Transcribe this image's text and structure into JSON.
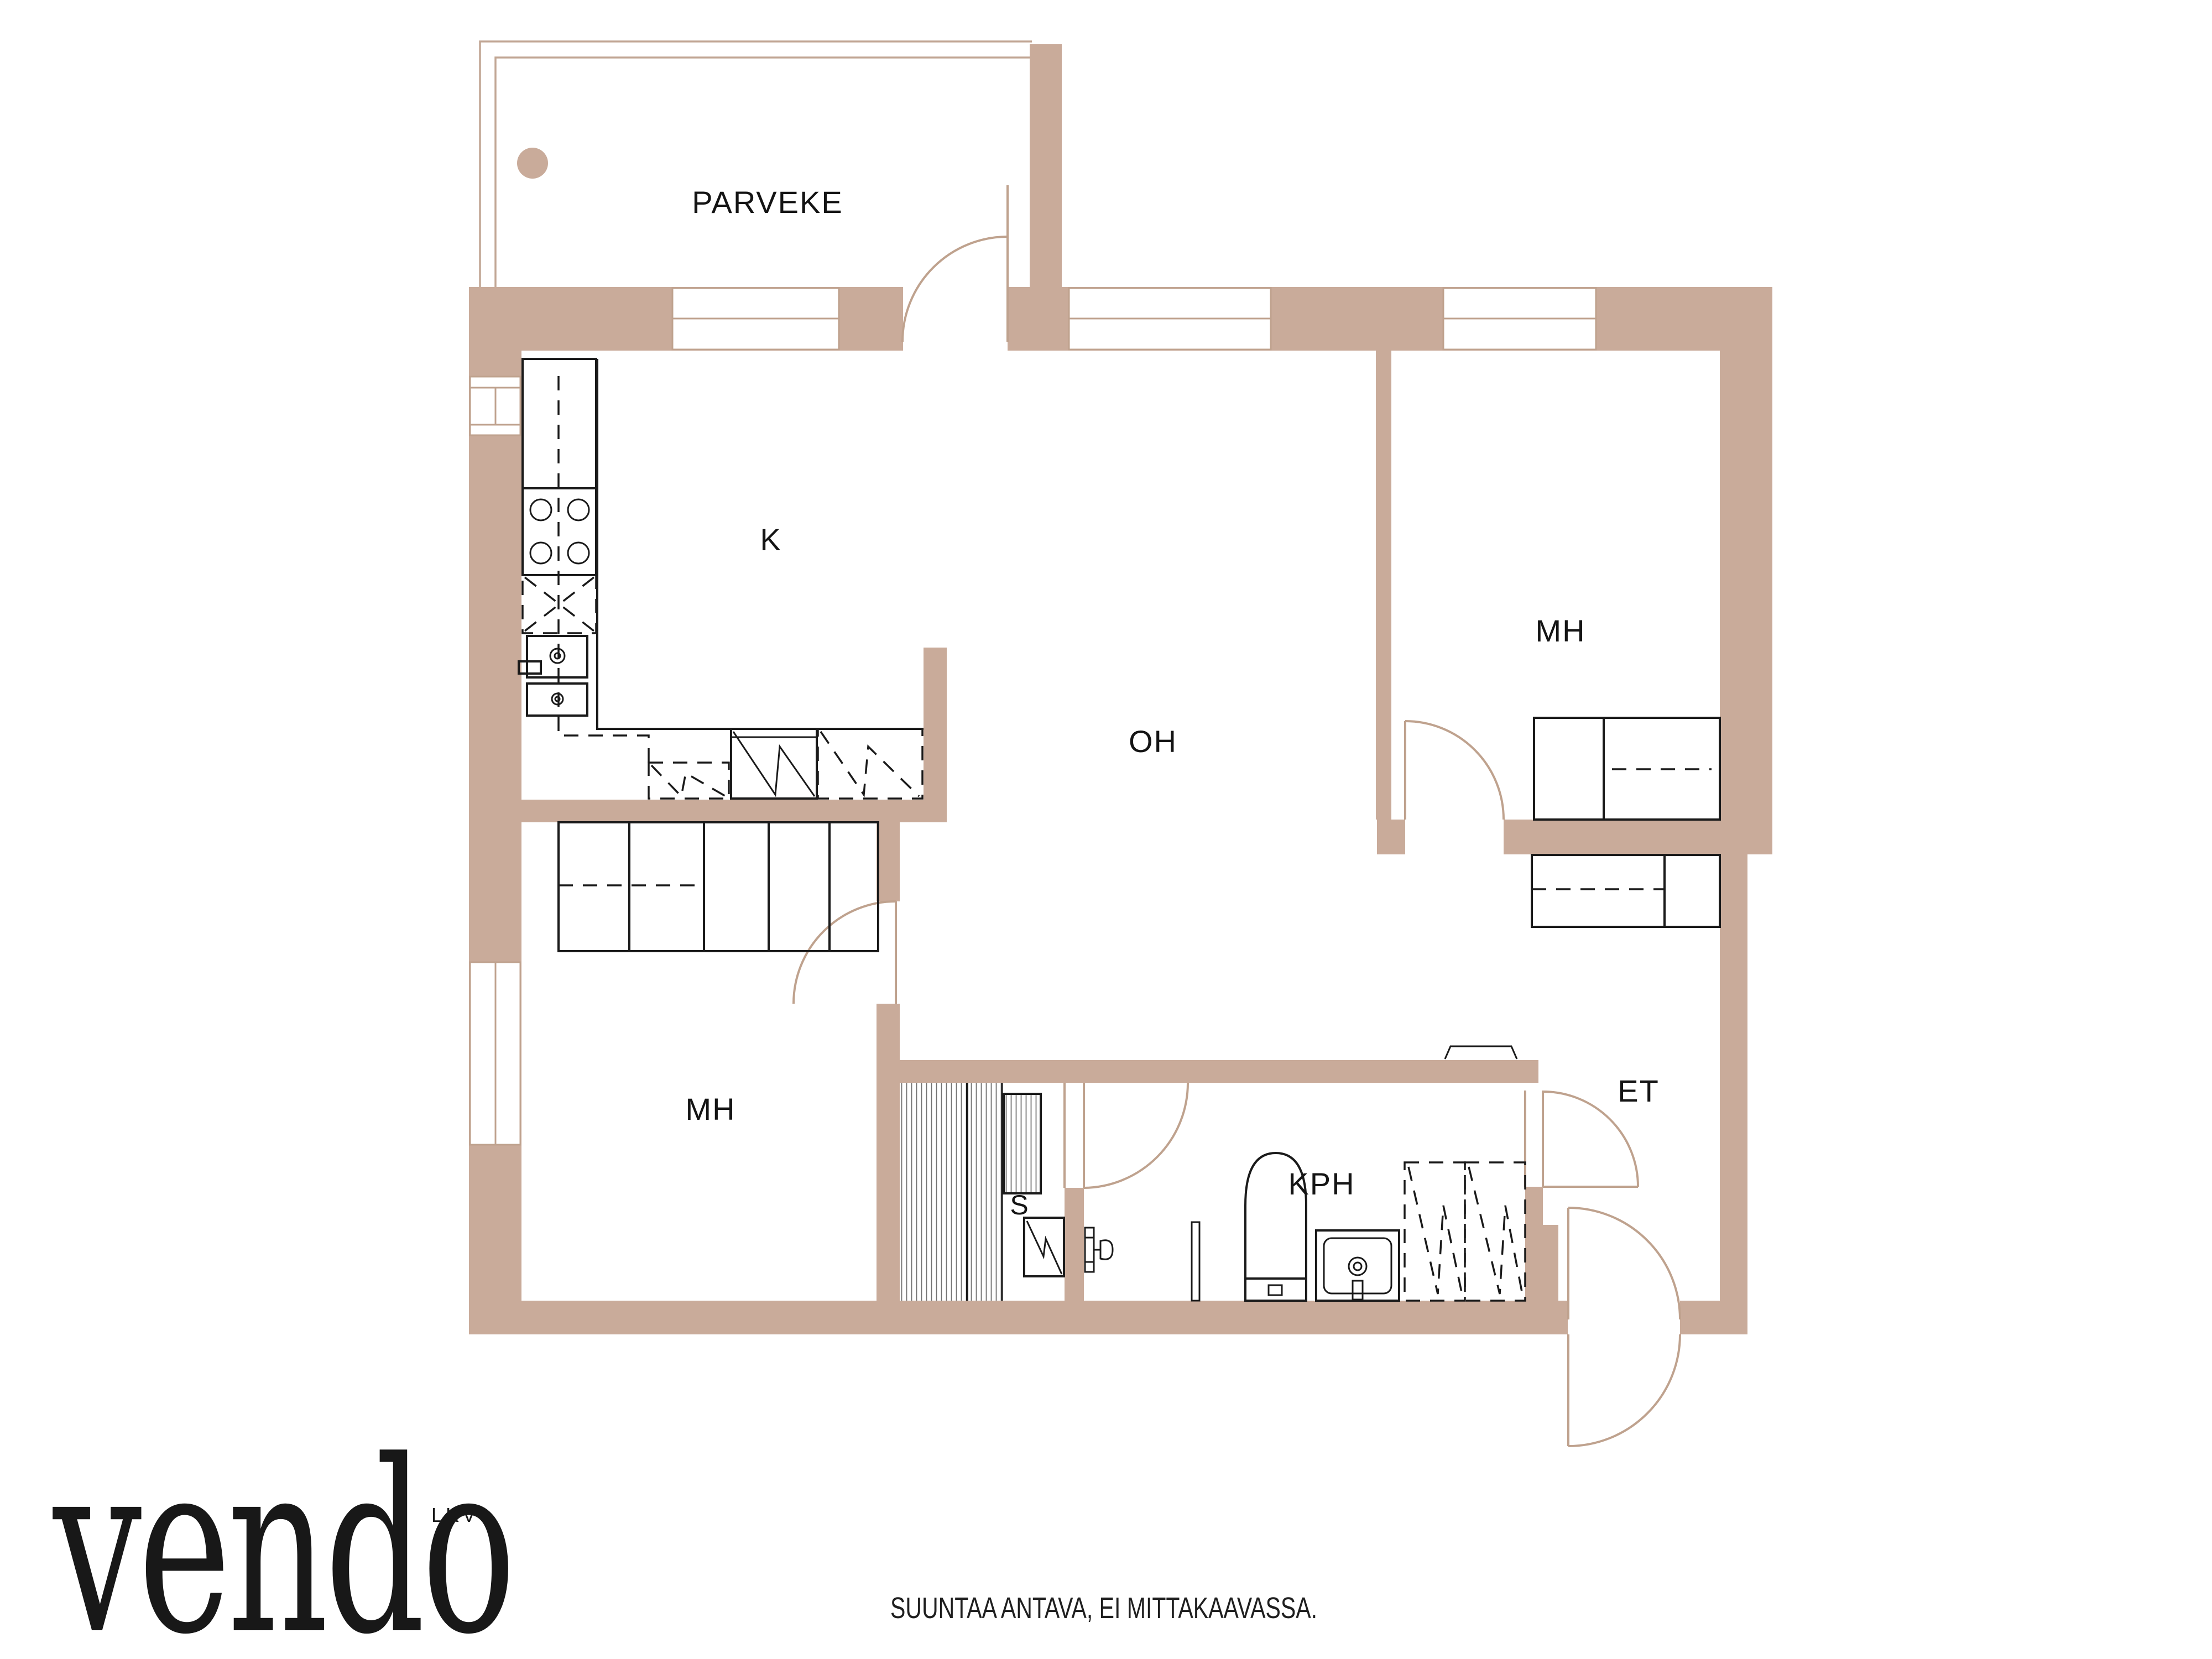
{
  "document": {
    "kind": "real-estate floor plan",
    "language": "Finnish"
  },
  "colors": {
    "wall": "#c9ab9a",
    "door_arc": "#bfa28e",
    "railing": "#c2a795",
    "line": "#1a1a1a",
    "stripe": "#737373",
    "text": "#141414",
    "background": "#ffffff"
  },
  "rooms": [
    {
      "id": "balcony",
      "label": "PARVEKE",
      "meaning": "balcony"
    },
    {
      "id": "kitchen",
      "label": "K",
      "meaning": "kitchen"
    },
    {
      "id": "living",
      "label": "OH",
      "meaning": "living room"
    },
    {
      "id": "bedroom_right",
      "label": "MH",
      "meaning": "bedroom"
    },
    {
      "id": "bedroom_left",
      "label": "MH",
      "meaning": "bedroom"
    },
    {
      "id": "entry",
      "label": "ET",
      "meaning": "entrance hall"
    },
    {
      "id": "bathroom",
      "label": "KPH",
      "meaning": "bathroom"
    },
    {
      "id": "sauna",
      "label": "S",
      "meaning": "sauna"
    }
  ],
  "branding": {
    "logo_text": "vendo",
    "logo_suffix": "LKV"
  },
  "footer": {
    "disclaimer": "SUUNTAA ANTAVA, EI MITTAKAAVASSA."
  }
}
